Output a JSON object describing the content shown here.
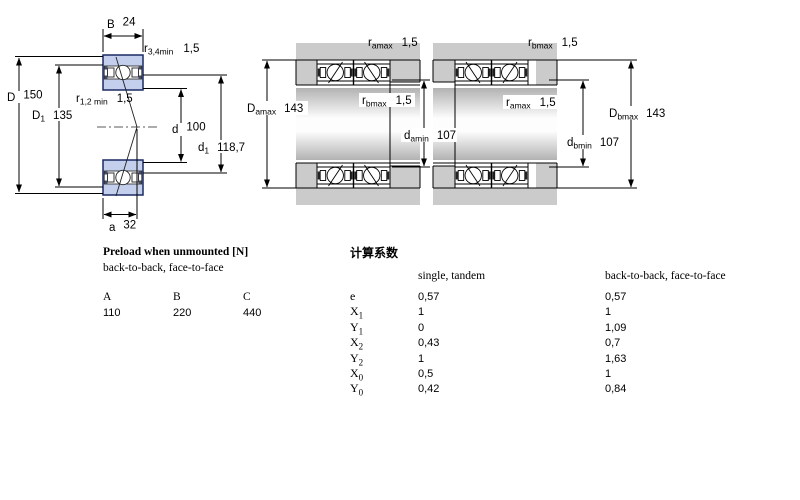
{
  "colors": {
    "line": "#000000",
    "bearing_fill": "#c3cfec",
    "bearing_border": "#1b2a63",
    "housing_gray": "#cbcbcb",
    "shaft_edge": "#b2b2b2"
  },
  "left_drawing": {
    "B": {
      "base": "B",
      "value": "24"
    },
    "r34": {
      "base": "r",
      "sub": "3,4min",
      "value": "1,5"
    },
    "D": {
      "base": "D",
      "value": "150"
    },
    "D1": {
      "base": "D",
      "sub": "1",
      "value": "135"
    },
    "r12": {
      "base": "r",
      "sub": "1,2 min",
      "value": "1,5"
    },
    "d": {
      "base": "d",
      "value": "100"
    },
    "d1": {
      "base": "d",
      "sub": "1",
      "value": "118,7"
    },
    "a": {
      "base": "a",
      "value": "32"
    }
  },
  "pair1": {
    "ra": {
      "base": "r",
      "sub": "amax",
      "value": "1,5"
    },
    "Da": {
      "base": "D",
      "sub": "amax",
      "value": "143"
    },
    "rb": {
      "base": "r",
      "sub": "bmax",
      "value": "1,5"
    },
    "da": {
      "base": "d",
      "sub": "amin",
      "value": "107"
    }
  },
  "pair2": {
    "rb": {
      "base": "r",
      "sub": "bmax",
      "value": "1,5"
    },
    "ra": {
      "base": "r",
      "sub": "amax",
      "value": "1,5"
    },
    "db": {
      "base": "d",
      "sub": "bmin",
      "value": "107"
    },
    "Db": {
      "base": "D",
      "sub": "bmax",
      "value": "143"
    }
  },
  "preload": {
    "title": "Preload when unmounted [N]",
    "subtitle": "back-to-back, face-to-face",
    "headers": [
      "A",
      "B",
      "C"
    ],
    "values": [
      "110",
      "220",
      "440"
    ]
  },
  "factors": {
    "title": "计算系数",
    "col1_header": "single, tandem",
    "col2_header": "back-to-back, face-to-face",
    "rows": [
      {
        "base": "e",
        "sub": "",
        "single": "0,57",
        "btb": "0,57"
      },
      {
        "base": "X",
        "sub": "1",
        "single": "1",
        "btb": "1"
      },
      {
        "base": "Y",
        "sub": "1",
        "single": "0",
        "btb": "1,09"
      },
      {
        "base": "X",
        "sub": "2",
        "single": "0,43",
        "btb": "0,7"
      },
      {
        "base": "Y",
        "sub": "2",
        "single": "1",
        "btb": "1,63"
      },
      {
        "base": "X",
        "sub": "0",
        "single": "0,5",
        "btb": "1"
      },
      {
        "base": "Y",
        "sub": "0",
        "single": "0,42",
        "btb": "0,84"
      }
    ]
  }
}
